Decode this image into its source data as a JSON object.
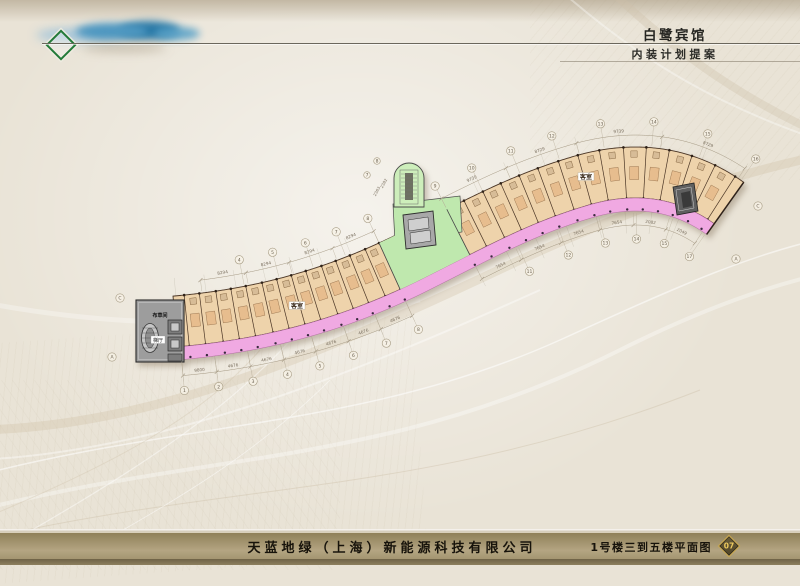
{
  "header": {
    "title": "白鹭宾馆",
    "subtitle": "内装计划提案"
  },
  "footer": {
    "company": "天蓝地绿（上海）新能源科技有限公司",
    "drawing_title": "1号楼三到五楼平面图",
    "page_number": "07"
  },
  "plan": {
    "room_labels": {
      "left": "客室",
      "right": "客室"
    },
    "service_labels": {
      "linen_room": "布草间",
      "stair_hall": "梯厅"
    },
    "colors": {
      "room_fill": "#eed3ab",
      "corridor_fill": "#f0a9e2",
      "corridor_edge": "#b06aa0",
      "core_green": "#bfe8ae",
      "capsule_green": "#cdeebb",
      "core_gray": "#9d9d9d",
      "wall": "#4a3525",
      "dim_line": "#a29680",
      "dim_text": "#7b7060"
    },
    "dim_chains": {
      "top_left": [
        "8294",
        "8294",
        "8294",
        "8294"
      ],
      "bottom_left": [
        "9800",
        "4676",
        "4676",
        "4676",
        "4676",
        "4676",
        "4676"
      ],
      "top_right": [
        "9739",
        "8729",
        "9739",
        "8729"
      ],
      "bottom_right": [
        "7654",
        "7654",
        "7654",
        "7654",
        "2082",
        "2049"
      ],
      "core": [
        "2363",
        "2382"
      ]
    },
    "grid_bubbles": {
      "bottom_left": [
        "1",
        "2",
        "3",
        "4",
        "5",
        "6",
        "7",
        "8"
      ],
      "top_left": [
        "4",
        "5",
        "6",
        "7",
        "8"
      ],
      "top_right": [
        "9",
        "10",
        "11",
        "12",
        "13",
        "14",
        "15",
        "16"
      ],
      "bottom_right": [
        "11",
        "12",
        "13",
        "14",
        "15",
        "17"
      ],
      "letters_left": [
        "C",
        "A"
      ],
      "letters_right": [
        "C",
        "A"
      ],
      "core": [
        "7",
        "8"
      ]
    }
  }
}
